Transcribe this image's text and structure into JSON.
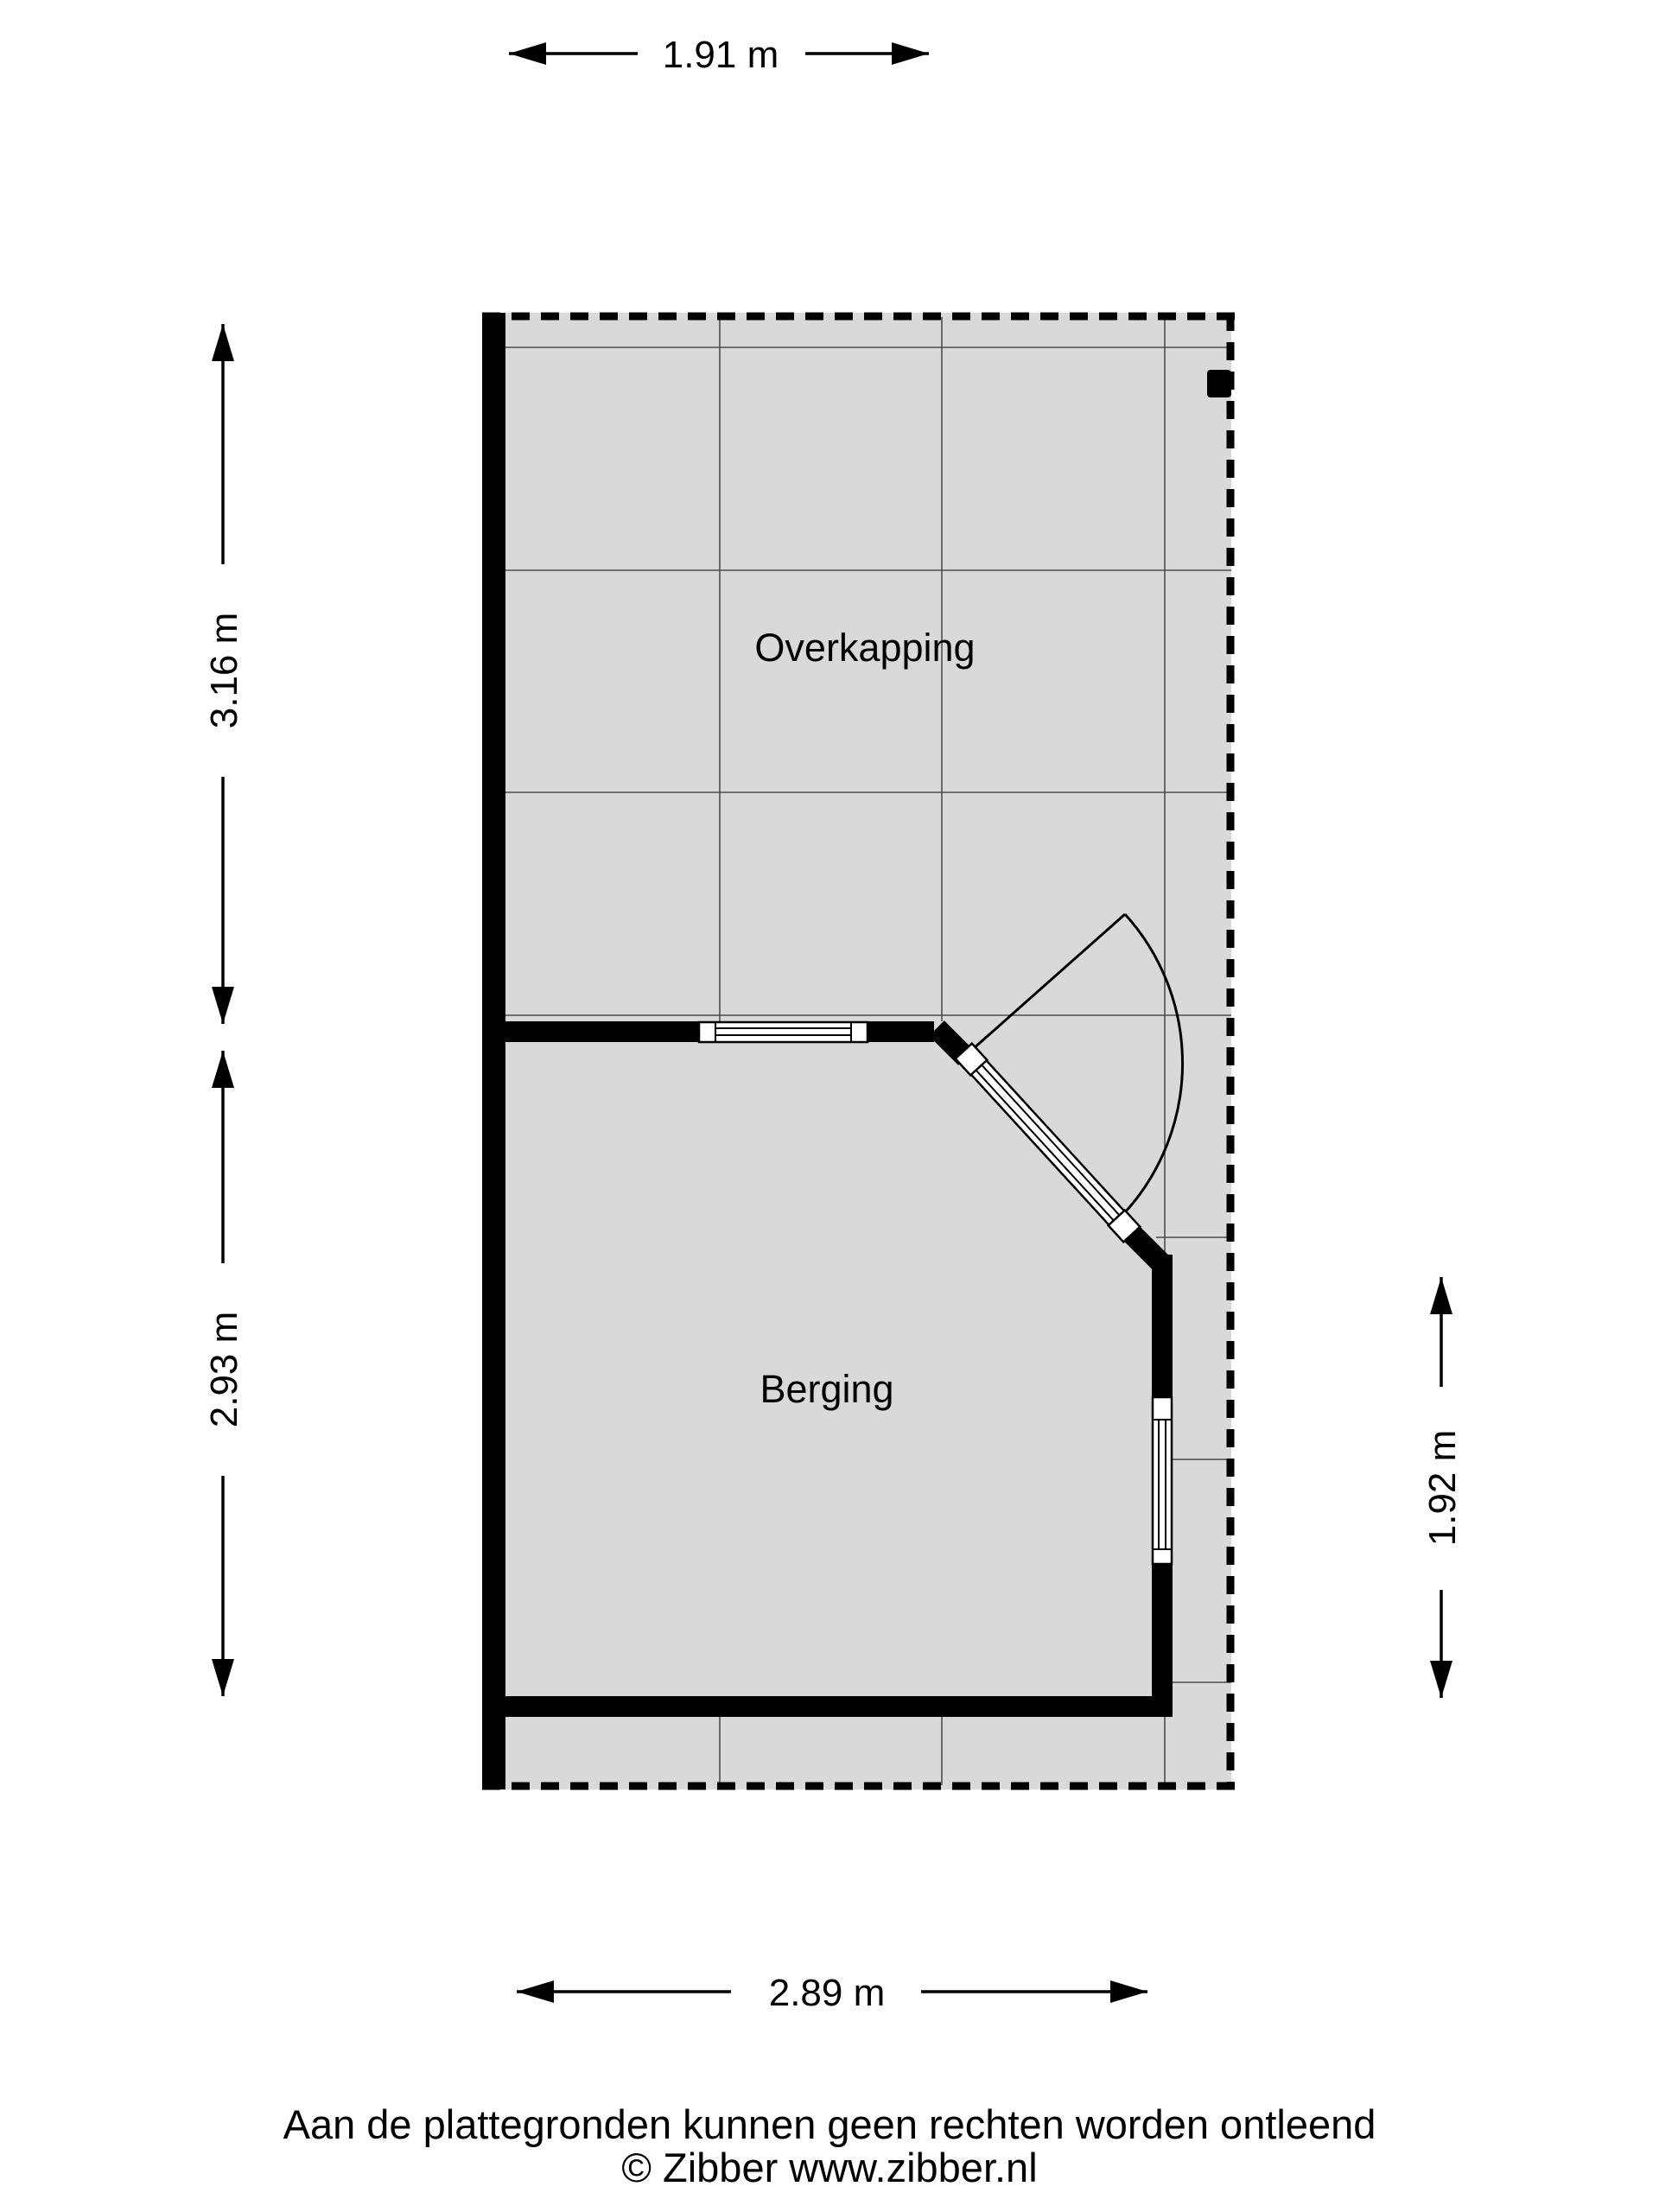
{
  "plan": {
    "rooms": [
      {
        "name": "Overkapping"
      },
      {
        "name": "Berging"
      }
    ],
    "dimensions": {
      "top": "1.91 m",
      "left_upper": "3.16 m",
      "left_lower": "2.93 m",
      "right": "1.92 m",
      "bottom": "2.89 m"
    },
    "colors": {
      "floor": "#d9d9d9",
      "wall": "#000000",
      "grid": "#4d4d4d",
      "background": "#ffffff"
    }
  },
  "footer": {
    "disclaimer": "Aan de plattegronden kunnen geen rechten worden ontleend",
    "copyright": "© Zibber www.zibber.nl"
  }
}
